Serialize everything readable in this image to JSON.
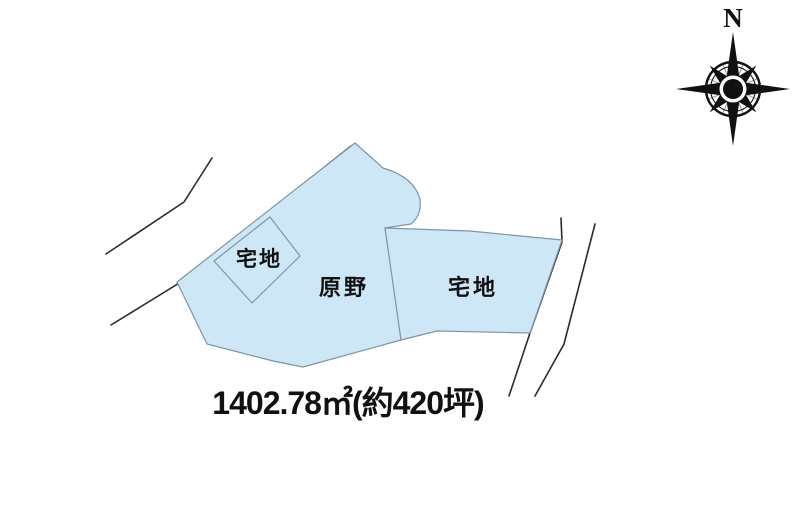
{
  "map": {
    "compass": {
      "north_label": "N"
    },
    "parcels": [
      {
        "label": "宅地"
      },
      {
        "label": "原野"
      },
      {
        "label": "宅地"
      }
    ],
    "area_text": "1402.78㎡(約420坪)",
    "colors": {
      "parcel_fill": "#cde7f6",
      "parcel_stroke": "#7f95a6",
      "road_line": "#2b2b2b",
      "text": "#111111"
    }
  }
}
